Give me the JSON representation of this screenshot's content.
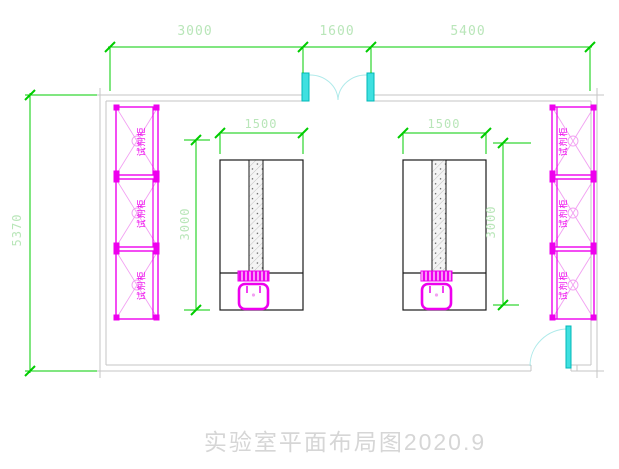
{
  "drawing": {
    "title": "实验室平面布局图2020.9",
    "colors": {
      "dimension_line": "#00cc00",
      "dimension_text": "#b9e6b9",
      "cabinet": "#ee00ee",
      "door": "#3fe0e0",
      "wall": "#c6c6c6",
      "bench": "#1a1a1a",
      "title_text": "#d6d6d6"
    },
    "dimensions": {
      "top_spans": [
        "3000",
        "1600",
        "5400"
      ],
      "overall_depth": "5370",
      "bench_left": {
        "width": "1500",
        "length": "3000"
      },
      "bench_right": {
        "width": "1500",
        "length": "3000"
      }
    },
    "cabinets": {
      "left": [
        "试剂柜",
        "试剂柜",
        "试剂柜"
      ],
      "right": [
        "试剂柜",
        "试剂柜",
        "试剂柜"
      ]
    }
  }
}
